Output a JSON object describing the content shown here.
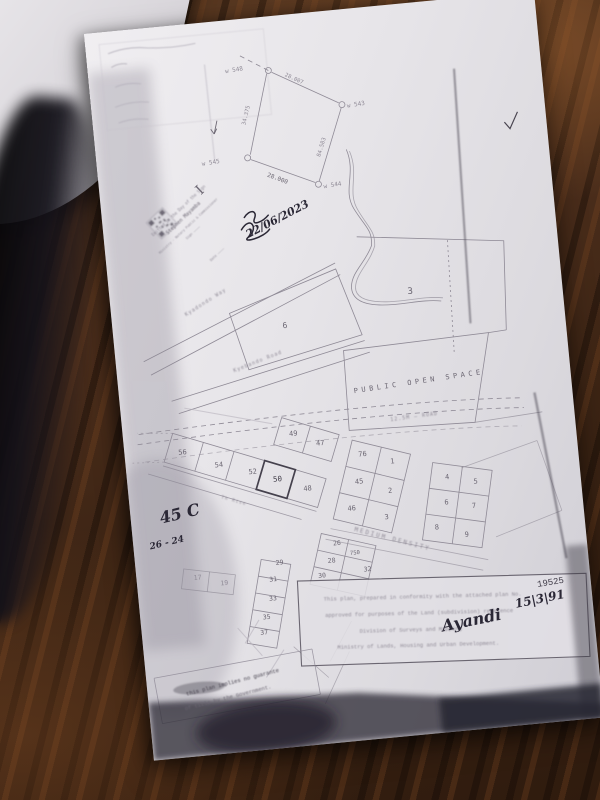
{
  "colors": {
    "wood": "#4a2d1b",
    "paper": "#e9e7ea",
    "plan_line": "#8f8a96",
    "bold_line": "#45414d",
    "ink": "#2a2735",
    "toner_smudge": "#34313c"
  },
  "plan": {
    "labels": [
      {
        "name": "survey-point-label",
        "text": "w 548",
        "x": 146,
        "y": 52,
        "s": 6,
        "r": -4,
        "cls": "t-faint"
      },
      {
        "name": "survey-point-label",
        "text": "w 543",
        "x": 264,
        "y": 98,
        "s": 6,
        "r": -4,
        "cls": "t-faint"
      },
      {
        "name": "survey-point-label",
        "text": "w 545",
        "x": 114,
        "y": 142,
        "s": 6,
        "r": -4,
        "cls": "t-faint"
      },
      {
        "name": "survey-point-label",
        "text": "w 544",
        "x": 233,
        "y": 176,
        "s": 6,
        "r": -4,
        "cls": "t-faint"
      },
      {
        "name": "survey-dimension",
        "text": "28.007",
        "x": 204,
        "y": 66,
        "s": 5.5,
        "r": 30,
        "cls": "t-faint"
      },
      {
        "name": "survey-dimension",
        "text": "34.375",
        "x": 155,
        "y": 97,
        "s": 5.5,
        "r": -71,
        "cls": "t-faint"
      },
      {
        "name": "survey-dimension",
        "text": "28.000",
        "x": 178,
        "y": 164,
        "s": 6,
        "r": 26,
        "cls": "t-line"
      },
      {
        "name": "survey-dimension",
        "text": "84.583",
        "x": 227,
        "y": 136,
        "s": 5.5,
        "r": -68,
        "cls": "t-faint"
      },
      {
        "name": "stamp-glyph",
        "text": "I",
        "x": 103,
        "y": 170,
        "s": 14,
        "r": -38,
        "cls": "t-line serif"
      },
      {
        "name": "stamp-text",
        "text": "Emitted in the Day of the Sign",
        "x": 78,
        "y": 186,
        "s": 4,
        "r": -38,
        "cls": "t-faint blurry"
      },
      {
        "name": "stamp-text",
        "text": "Stephen Mayamba",
        "x": 82,
        "y": 194,
        "s": 5,
        "r": -38,
        "cls": "t-line blurry"
      },
      {
        "name": "stamp-text",
        "text": "Ministry · Notary Public & Commissioner",
        "x": 86,
        "y": 202,
        "s": 3.4,
        "r": -38,
        "cls": "t-faint blurry"
      },
      {
        "name": "stamp-text",
        "text": "Sign ————",
        "x": 90,
        "y": 209,
        "s": 3.4,
        "r": -38,
        "cls": "t-faint blurry"
      },
      {
        "name": "stamp-text",
        "text": "Date ————",
        "x": 112,
        "y": 233,
        "s": 3.4,
        "r": -38,
        "cls": "t-faint blurry"
      },
      {
        "name": "handwritten-date",
        "text": "22/06/2023",
        "x": 176,
        "y": 206,
        "s": 11,
        "r": -22,
        "cls": "t-ink"
      },
      {
        "name": "road-label",
        "text": "Kyadondo Way",
        "x": 96,
        "y": 280,
        "s": 5,
        "r": -27,
        "ls": 1,
        "cls": "t-faint blurry"
      },
      {
        "name": "road-label",
        "text": "Kyebando Road",
        "x": 142,
        "y": 344,
        "s": 5,
        "r": -16,
        "ls": 1,
        "cls": "t-faint blurry"
      },
      {
        "name": "road-label",
        "text": "12.5M — ROAD",
        "x": 292,
        "y": 414,
        "s": 5,
        "r": -2,
        "ls": 1,
        "cls": "t-faint blurry"
      },
      {
        "name": "road-label",
        "text": "Th Rise",
        "x": 104,
        "y": 480,
        "s": 4.5,
        "r": 21,
        "ls": 1,
        "cls": "t-faint blurry"
      },
      {
        "name": "zone-label",
        "text": "PUBLIC OPEN SPACE",
        "x": 300,
        "y": 380,
        "s": 7,
        "r": -3,
        "ls": 3.5,
        "cls": "t-line"
      },
      {
        "name": "zone-label",
        "text": "MEDIUM DENSITY",
        "x": 258,
        "y": 534,
        "s": 6,
        "r": 20,
        "ls": 2,
        "cls": "t-faint blurry"
      },
      {
        "name": "parcel-number",
        "text": "3",
        "x": 300,
        "y": 290,
        "s": 9,
        "r": 0,
        "cls": "t-line"
      },
      {
        "name": "parcel-number",
        "text": "6",
        "x": 172,
        "y": 312,
        "s": 8,
        "r": 0,
        "cls": "t-line"
      },
      {
        "name": "plot-number",
        "text": "56",
        "x": 58,
        "y": 428,
        "s": 7,
        "r": 0,
        "cls": "t-line"
      },
      {
        "name": "plot-number",
        "text": "54",
        "x": 93,
        "y": 444,
        "s": 7,
        "r": 0,
        "cls": "t-line"
      },
      {
        "name": "plot-number",
        "text": "52",
        "x": 126,
        "y": 454,
        "s": 7,
        "r": 0,
        "cls": "t-line"
      },
      {
        "name": "plot-number",
        "text": "50",
        "x": 150,
        "y": 464,
        "s": 7.5,
        "r": 0,
        "cls": "t-dark"
      },
      {
        "name": "plot-number",
        "text": "48",
        "x": 179,
        "y": 476,
        "s": 7,
        "r": 0,
        "cls": "t-line"
      },
      {
        "name": "plot-number",
        "text": "49",
        "x": 170,
        "y": 420,
        "s": 7,
        "r": 0,
        "cls": "t-line"
      },
      {
        "name": "plot-number",
        "text": "47",
        "x": 196,
        "y": 432,
        "s": 7,
        "r": 0,
        "cls": "t-line"
      },
      {
        "name": "plot-number",
        "text": "76",
        "x": 237,
        "y": 447,
        "s": 7,
        "r": 0,
        "cls": "t-line"
      },
      {
        "name": "plot-number",
        "text": "1",
        "x": 266,
        "y": 457,
        "s": 7,
        "r": 0,
        "cls": "t-line"
      },
      {
        "name": "plot-number",
        "text": "45",
        "x": 231,
        "y": 474,
        "s": 7,
        "r": 0,
        "cls": "t-line"
      },
      {
        "name": "plot-number",
        "text": "2",
        "x": 261,
        "y": 486,
        "s": 7,
        "r": 0,
        "cls": "t-line"
      },
      {
        "name": "plot-number",
        "text": "46",
        "x": 221,
        "y": 500,
        "s": 7,
        "r": 0,
        "cls": "t-line"
      },
      {
        "name": "plot-number",
        "text": "3",
        "x": 255,
        "y": 512,
        "s": 7,
        "r": 0,
        "cls": "t-line"
      },
      {
        "name": "plot-number",
        "text": "4",
        "x": 319,
        "y": 478,
        "s": 7,
        "r": 0,
        "cls": "t-line"
      },
      {
        "name": "plot-number",
        "text": "5",
        "x": 347,
        "y": 485,
        "s": 7,
        "r": 0,
        "cls": "t-line"
      },
      {
        "name": "plot-number",
        "text": "6",
        "x": 316,
        "y": 503,
        "s": 7,
        "r": 0,
        "cls": "t-line"
      },
      {
        "name": "plot-number",
        "text": "7",
        "x": 343,
        "y": 509,
        "s": 7,
        "r": 0,
        "cls": "t-line"
      },
      {
        "name": "plot-number",
        "text": "8",
        "x": 304,
        "y": 527,
        "s": 7,
        "r": 0,
        "cls": "t-line"
      },
      {
        "name": "plot-number",
        "text": "9",
        "x": 333,
        "y": 537,
        "s": 7,
        "r": 0,
        "cls": "t-line"
      },
      {
        "name": "plot-number",
        "text": "29",
        "x": 144,
        "y": 547,
        "s": 6.5,
        "r": 0,
        "cls": "t-line"
      },
      {
        "name": "plot-number",
        "text": "31",
        "x": 136,
        "y": 563,
        "s": 6.5,
        "r": 0,
        "cls": "t-line"
      },
      {
        "name": "plot-number",
        "text": "33",
        "x": 134,
        "y": 582,
        "s": 6.5,
        "r": 0,
        "cls": "t-line"
      },
      {
        "name": "plot-number",
        "text": "35",
        "x": 126,
        "y": 600,
        "s": 6.5,
        "r": 0,
        "cls": "t-line"
      },
      {
        "name": "plot-number",
        "text": "37",
        "x": 122,
        "y": 615,
        "s": 6.5,
        "r": 0,
        "cls": "t-line"
      },
      {
        "name": "plot-number",
        "text": "19",
        "x": 87,
        "y": 562,
        "s": 6.5,
        "r": 0,
        "cls": "t-faint"
      },
      {
        "name": "plot-number",
        "text": "17",
        "x": 61,
        "y": 554,
        "s": 6.5,
        "r": 0,
        "cls": "t-faint"
      },
      {
        "name": "plot-number",
        "text": "26",
        "x": 203,
        "y": 533,
        "s": 6.5,
        "r": 0,
        "cls": "t-line"
      },
      {
        "name": "plot-number",
        "text": "750",
        "x": 220,
        "y": 544,
        "s": 5.5,
        "r": 0,
        "cls": "t-line"
      },
      {
        "name": "plot-number",
        "text": "28",
        "x": 196,
        "y": 550,
        "s": 6.5,
        "r": 0,
        "cls": "t-line"
      },
      {
        "name": "plot-number",
        "text": "30",
        "x": 185,
        "y": 564,
        "s": 6.5,
        "r": 0,
        "cls": "t-line"
      },
      {
        "name": "plot-number",
        "text": "32",
        "x": 231,
        "y": 562,
        "s": 6.5,
        "r": 0,
        "cls": "t-line"
      },
      {
        "name": "handwritten-note",
        "text": "45 C",
        "x": 50,
        "y": 492,
        "s": 16,
        "r": -8,
        "cls": "t-ink"
      },
      {
        "name": "handwritten-note",
        "text": "26 - 24",
        "x": 34,
        "y": 517,
        "s": 9,
        "r": -8,
        "cls": "t-ink"
      },
      {
        "name": "certificate-text",
        "text": "This plan, prepared in conformity with the attached plan No.",
        "x": 283,
        "y": 594,
        "s": 5.5,
        "r": 4,
        "cls": "t-faint mono blurry"
      },
      {
        "name": "plan-number",
        "text": "19525",
        "x": 412,
        "y": 593,
        "s": 9,
        "r": -4,
        "cls": "t-dark mono"
      },
      {
        "name": "certificate-text",
        "text": "approved for purposes of the Land (subdivision) reference",
        "x": 278,
        "y": 610,
        "s": 5.5,
        "r": 4,
        "cls": "t-faint mono blurry"
      },
      {
        "name": "certificate-text",
        "text": "Division of Surveys and Mapping",
        "x": 268,
        "y": 626,
        "s": 5.5,
        "r": 4,
        "cls": "t-faint mono blurry"
      },
      {
        "name": "certificate-text",
        "text": "Ministry of Lands, Housing and Urban Development.",
        "x": 274,
        "y": 642,
        "s": 5.5,
        "r": 4,
        "cls": "t-faint mono blurry"
      },
      {
        "name": "approval-signature",
        "text": "Ayandi",
        "x": 330,
        "y": 626,
        "s": 16,
        "r": -6,
        "cls": "t-ink script"
      },
      {
        "name": "approval-date",
        "text": "15|3|91",
        "x": 400,
        "y": 610,
        "s": 12,
        "r": -6,
        "cls": "t-ink"
      },
      {
        "name": "guarantee-stamp-text",
        "text": "this plan implies no guarante",
        "x": 86,
        "y": 661,
        "s": 5.5,
        "r": -9,
        "cls": "t-dark mono blurry"
      },
      {
        "name": "guarantee-stamp-text",
        "text": "of title by the Government.",
        "x": 80,
        "y": 676,
        "s": 5.5,
        "r": -9,
        "cls": "t-line mono blurry"
      }
    ]
  }
}
